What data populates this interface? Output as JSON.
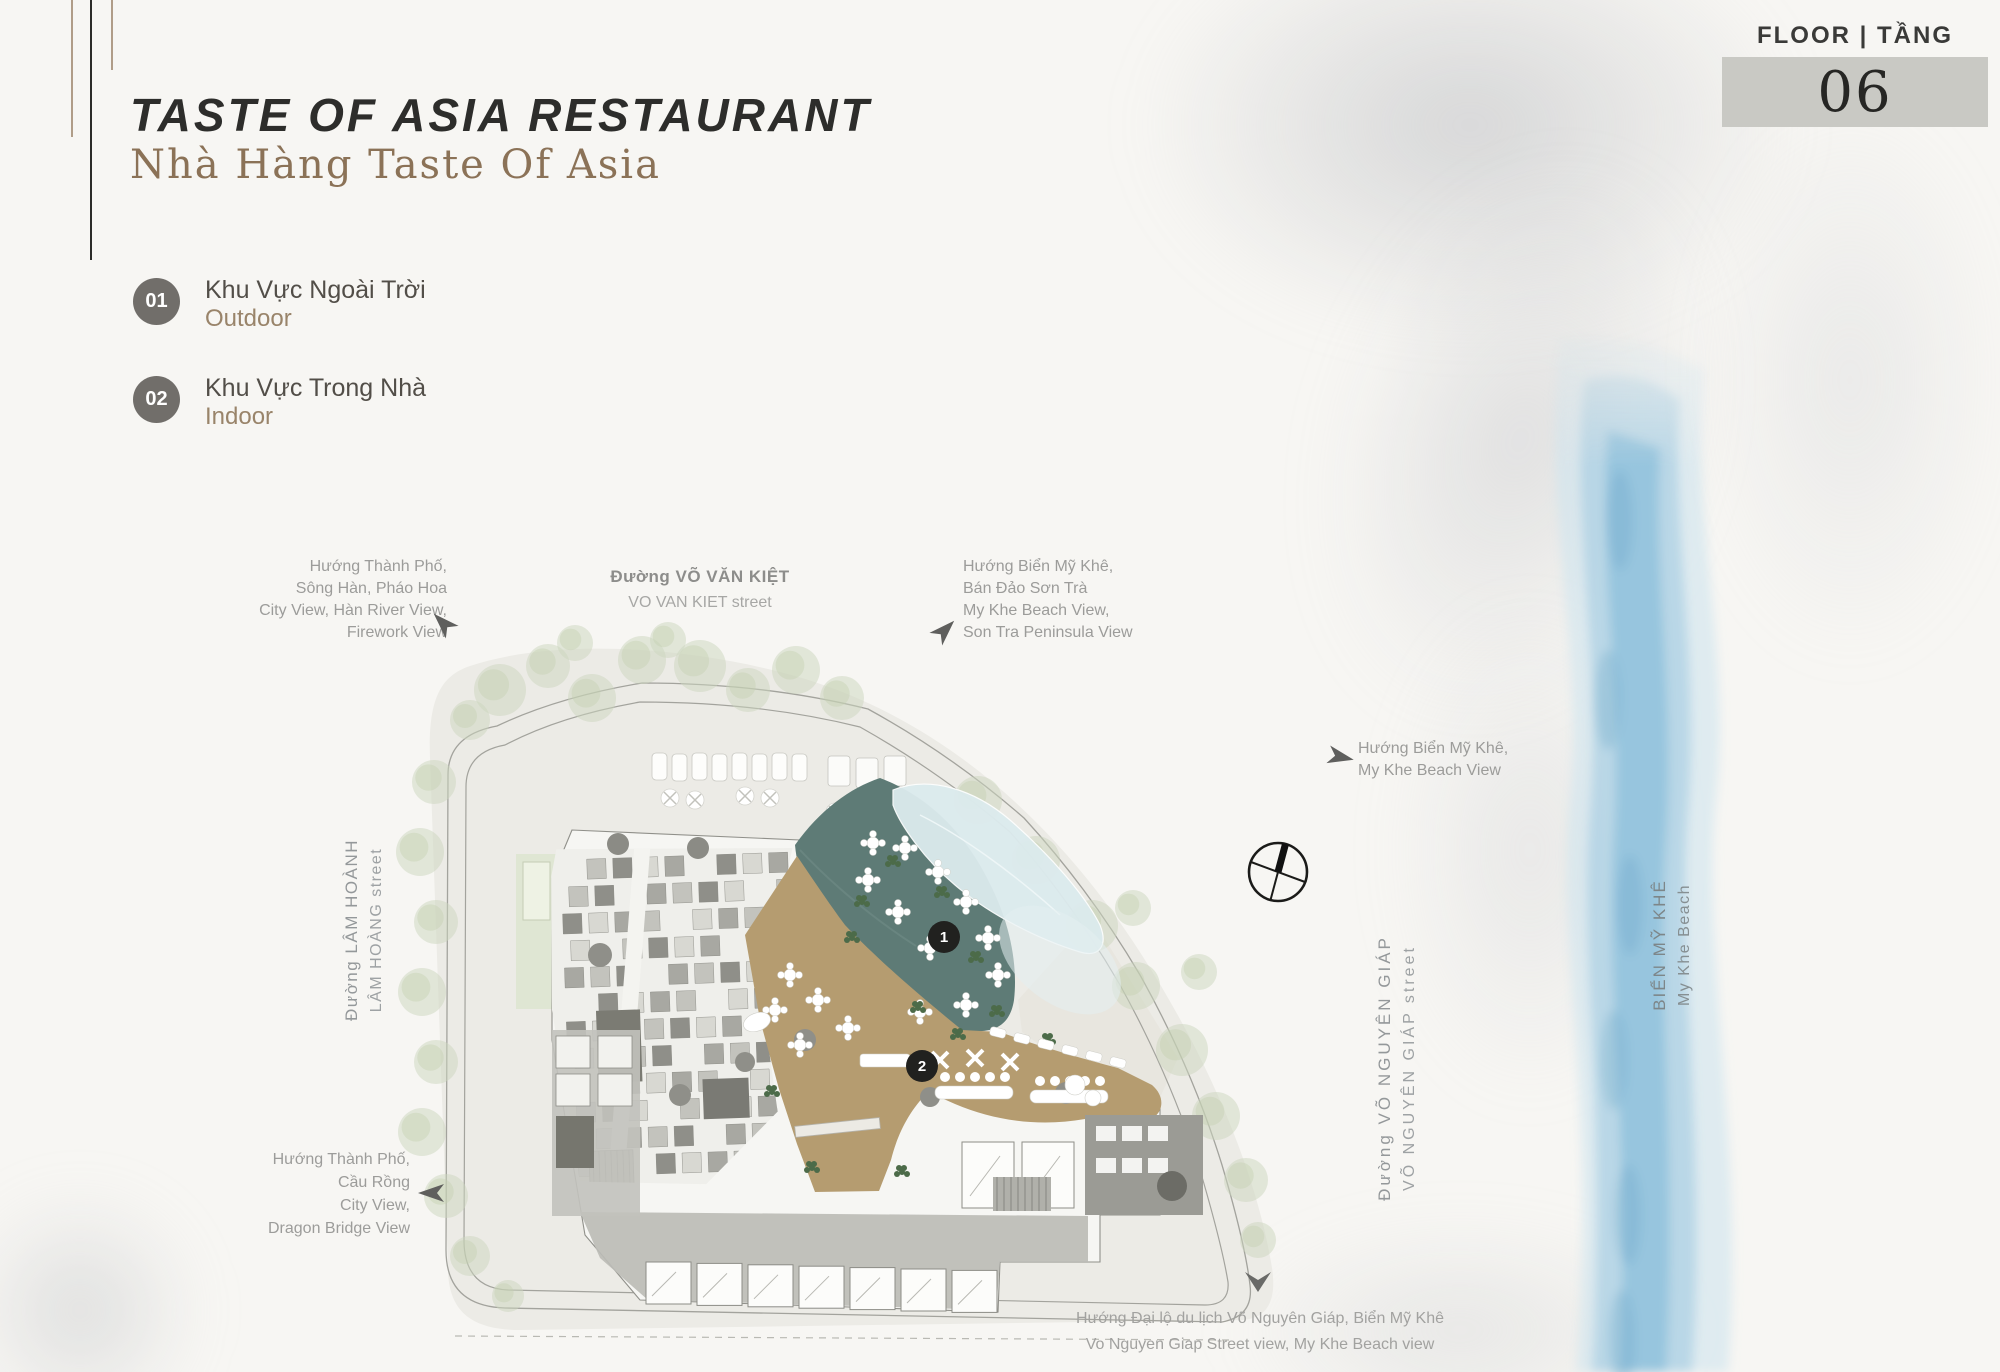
{
  "header": {
    "title": "TASTE OF ASIA RESTAURANT",
    "subtitle": "Nhà Hàng Taste Of Asia"
  },
  "floor_badge": {
    "label": "FLOOR | TẦNG",
    "number": "06"
  },
  "legend": {
    "items": [
      {
        "number": "01",
        "vi": "Khu Vực Ngoài Trời",
        "en": "Outdoor"
      },
      {
        "number": "02",
        "vi": "Khu Vực Trong Nhà",
        "en": "Indoor"
      }
    ]
  },
  "plan": {
    "markers": [
      {
        "number": "1"
      },
      {
        "number": "2"
      }
    ]
  },
  "labels": {
    "city_view_top": {
      "lines": [
        "Hướng Thành Phố,",
        "Sông Hàn, Pháo Hoa",
        "City View, Hàn River View,",
        "Firework View"
      ]
    },
    "vo_van_kiet": {
      "vi": "Đường VÕ VĂN KIỆT",
      "en": "VO VAN KIET street"
    },
    "my_khe_top": {
      "lines": [
        "Hướng Biển Mỹ Khê,",
        "Bán Đảo Sơn Trà",
        "My Khe Beach View,",
        "Son Tra Peninsula View"
      ]
    },
    "my_khe_right": {
      "lines": [
        "Hướng Biển Mỹ Khê,",
        "My Khe Beach View"
      ]
    },
    "lam_hoanh": {
      "vi": "Đường LÂM HOÀNH",
      "en": "LÂM HOÀNG street"
    },
    "vo_nguyen_giap": {
      "vi": "Đường VÕ NGUYÊN GIÁP",
      "en": "VÕ NGUYÊN GIÁP street"
    },
    "bien_my_khe": {
      "vi": "BIỂN MỸ KHÊ",
      "en": "My Khe Beach"
    },
    "city_view_bottom": {
      "lines": [
        "Hướng Thành Phố,",
        "Cầu Rồng",
        "City View,",
        "Dragon Bridge View"
      ]
    },
    "bottom": {
      "lines": [
        "Hướng Đại lộ du lịch Võ Nguyên Giáp, Biển Mỹ Khê",
        "Vo Nguyen Giap Street view, My Khe Beach view"
      ]
    }
  },
  "colors": {
    "accent_brown": "#8b7257",
    "teal_terrace": "#5e7b76",
    "tan_indoor": "#b59c70",
    "pool_blue": "#dcebee",
    "floor_box": "#c9c9c4",
    "sea_blue": "#a9cfe2"
  }
}
